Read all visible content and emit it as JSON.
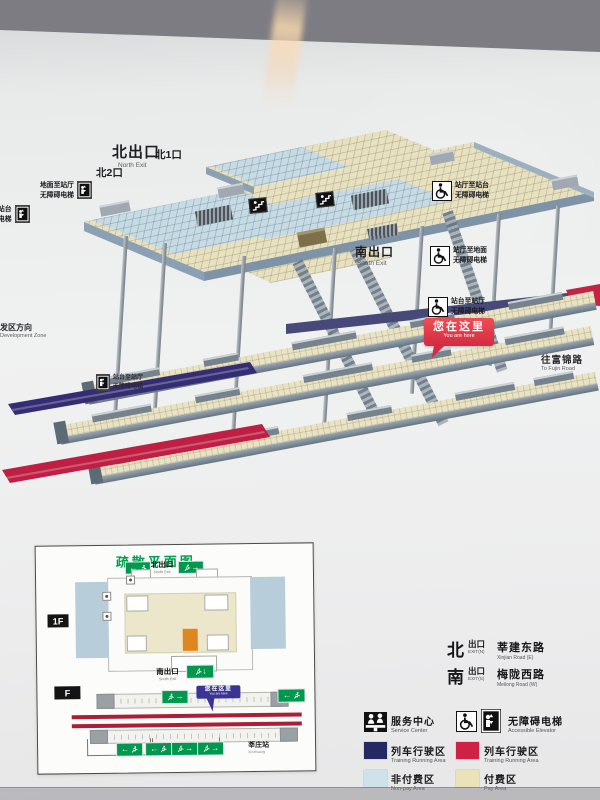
{
  "map3d": {
    "north_exit_zh": "北出口",
    "north_exit_en": "North Exit",
    "exit_n2": "北2口",
    "exit_n1": "北1口",
    "south_exit_zh": "南出口",
    "south_exit_en": "South Exit",
    "elev_ground_hall_1": "地面至站厅",
    "elev_ground_hall_2": "无障碍电梯",
    "elev_partial_1": "站台",
    "elev_partial_2": "电梯",
    "elev_hall_platform_1": "站厅至站台",
    "elev_hall_platform_2": "无障碍电梯",
    "elev_hall_ground_1": "站厅至地面",
    "elev_hall_ground_2": "无障碍电梯",
    "elev_platform_hall_1": "站台至站厅",
    "elev_platform_hall_2": "无障碍电梯",
    "elev_mid_1": "站台至站厅",
    "elev_mid_2": "无障碍电梯",
    "you_are_here_zh": "您在这里",
    "you_are_here_en": "You are here",
    "dev_zone_zh": "发区方向",
    "dev_zone_en": "Development Zone",
    "fujin_zh": "往富锦路",
    "fujin_en": "To Fujin Road"
  },
  "evac": {
    "title": "疏散平面图",
    "north_exit_zh": "北出口",
    "north_exit_en": "North Exit",
    "south_exit_zh": "南出口",
    "south_exit_en": "South Exit",
    "floor_upper": "1F",
    "floor_lower": "F",
    "you_are_here_zh": "您在这里",
    "you_are_here_en": "You are here",
    "station_zh": "莘庄站",
    "station_en": "Xinzhuang"
  },
  "legend": {
    "exit_n": {
      "dir": "北",
      "exit_zh": "出口",
      "exit_en": "EXIT(N)",
      "road_zh": "莘建东路",
      "road_en": "Xinjian Road (E)"
    },
    "exit_s": {
      "dir": "南",
      "exit_zh": "出口",
      "exit_en": "EXIT(S)",
      "road_zh": "梅陇西路",
      "road_en": "Meilong Road (W)"
    },
    "service_zh": "服务中心",
    "service_en": "Service Center",
    "accessible_zh": "无障碍电梯",
    "accessible_en": "Accessible Elevator",
    "train_navy_zh": "列车行驶区",
    "train_navy_en": "Training Running Area",
    "train_red_zh": "列车行驶区",
    "train_red_en": "Training Running Area",
    "nonpay_zh": "非付费区",
    "nonpay_en": "Non-pay Area",
    "pay_zh": "付费区",
    "pay_en": "Pay Area"
  },
  "icons": {
    "arrow_left": "←",
    "arrow_right": "→",
    "arrow_down": "↓"
  },
  "colors": {
    "train_navy": "#232a63",
    "train_red": "#ce2144",
    "nonpay": "#cfe2ea",
    "pay": "#eae3ba",
    "exit_green": "#00984f",
    "you_are_here_red": "#d42b40",
    "you_are_here_purple": "#3c3494",
    "title_green": "#00a050"
  }
}
